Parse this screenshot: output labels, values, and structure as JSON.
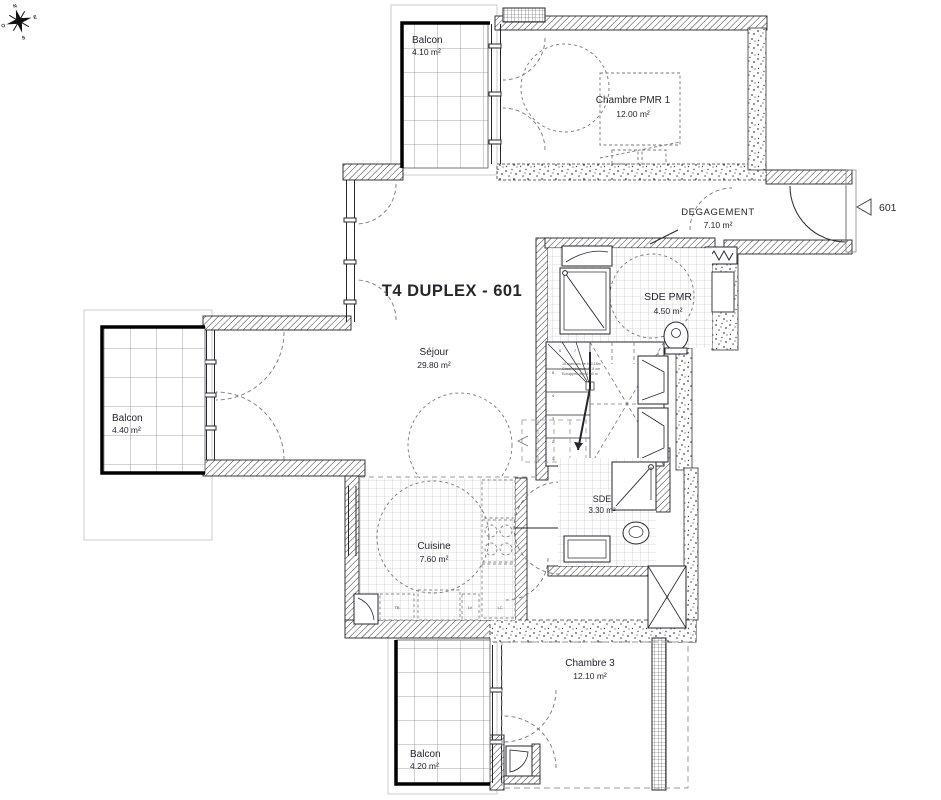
{
  "title": "T4 DUPLEX - 601",
  "entrance": {
    "tag": "601"
  },
  "compass": {
    "north": "N",
    "south": "S",
    "east": "E",
    "west": "O"
  },
  "rooms": {
    "balcon_top": {
      "name": "Balcon",
      "area": "4.10 m²"
    },
    "chambre_pmr1": {
      "name": "Chambre PMR 1",
      "area": "12.00 m²"
    },
    "degagement": {
      "name": "DEGAGEMENT",
      "area": "7.10 m²"
    },
    "sde_pmr": {
      "name": "SDE PMR",
      "area": "4.50 m²"
    },
    "sejour": {
      "name": "Séjour",
      "area": "29.80 m²"
    },
    "balcon_left": {
      "name": "Balcon",
      "area": "4.40 m²"
    },
    "cuisine": {
      "name": "Cuisine",
      "area": "7.60 m²"
    },
    "sde": {
      "name": "SDE",
      "area": "3.30 m²"
    },
    "chambre3": {
      "name": "Chambre 3",
      "area": "12.10 m²"
    },
    "balcon_bottom": {
      "name": "Balcon",
      "area": "4.20 m²"
    }
  },
  "labels": {
    "closet": "PL",
    "kitchen_tb": "TB",
    "kitchen_lv": "LV",
    "kitchen_lc": "LC"
  },
  "stairs": {
    "note1": "16 marches de h: 0,18m",
    "note2": "Giron minimum 17,8 cm",
    "note3": "Echappée mini 1,90 m",
    "s1": "1",
    "s2": "2",
    "s3": "3",
    "s4": "4",
    "s5": "5",
    "s6": "6",
    "s7": "7",
    "s8": "8",
    "s9": "9",
    "s10": "10",
    "s11": "11",
    "s12": "12"
  },
  "colors": {
    "line": "#26262e",
    "wall_hatch": "#3a3a3a",
    "tile": "#b9b9c0"
  }
}
